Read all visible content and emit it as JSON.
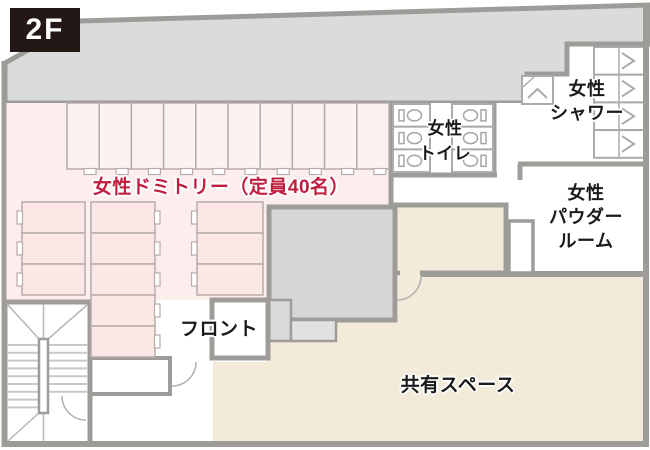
{
  "floor_badge": "2F",
  "labels": {
    "dormitory": "女性ドミトリー（定員40名）",
    "front_desk": "フロント",
    "shared_space": "共有スペース",
    "toilet_line1": "女性",
    "toilet_line2": "トイレ",
    "shower_line1": "女性",
    "shower_line2": "シャワー",
    "powder_line1": "女性",
    "powder_line2": "パウダー",
    "powder_line3": "ルーム"
  },
  "rooms": [
    {
      "name": "womens-dormitory",
      "label": "女性ドミトリー（定員40名）",
      "capacity": 40,
      "beds_top_row": 10,
      "beds_left_block": 3,
      "beds_middle_block": 5,
      "beds_right_block": 3
    },
    {
      "name": "front-desk",
      "label": "フロント"
    },
    {
      "name": "shared-space",
      "label": "共有スペース"
    },
    {
      "name": "womens-toilet",
      "label": "女性トイレ",
      "stalls": 6
    },
    {
      "name": "womens-shower",
      "label": "女性シャワー",
      "stalls": 5
    },
    {
      "name": "womens-powder-room",
      "label": "女性パウダールーム"
    },
    {
      "name": "staircase"
    }
  ],
  "colors": {
    "dormitory_pink": "#fdeeee",
    "bed_pink": "#fbe7e5",
    "shared_beige": "#f2ebd9",
    "corridor_gray": "#dbdbdb",
    "wall_gray": "#9e9c99",
    "accent_red": "#bf1e3e",
    "text_black": "#1a1a1a",
    "badge_black": "#231815"
  }
}
